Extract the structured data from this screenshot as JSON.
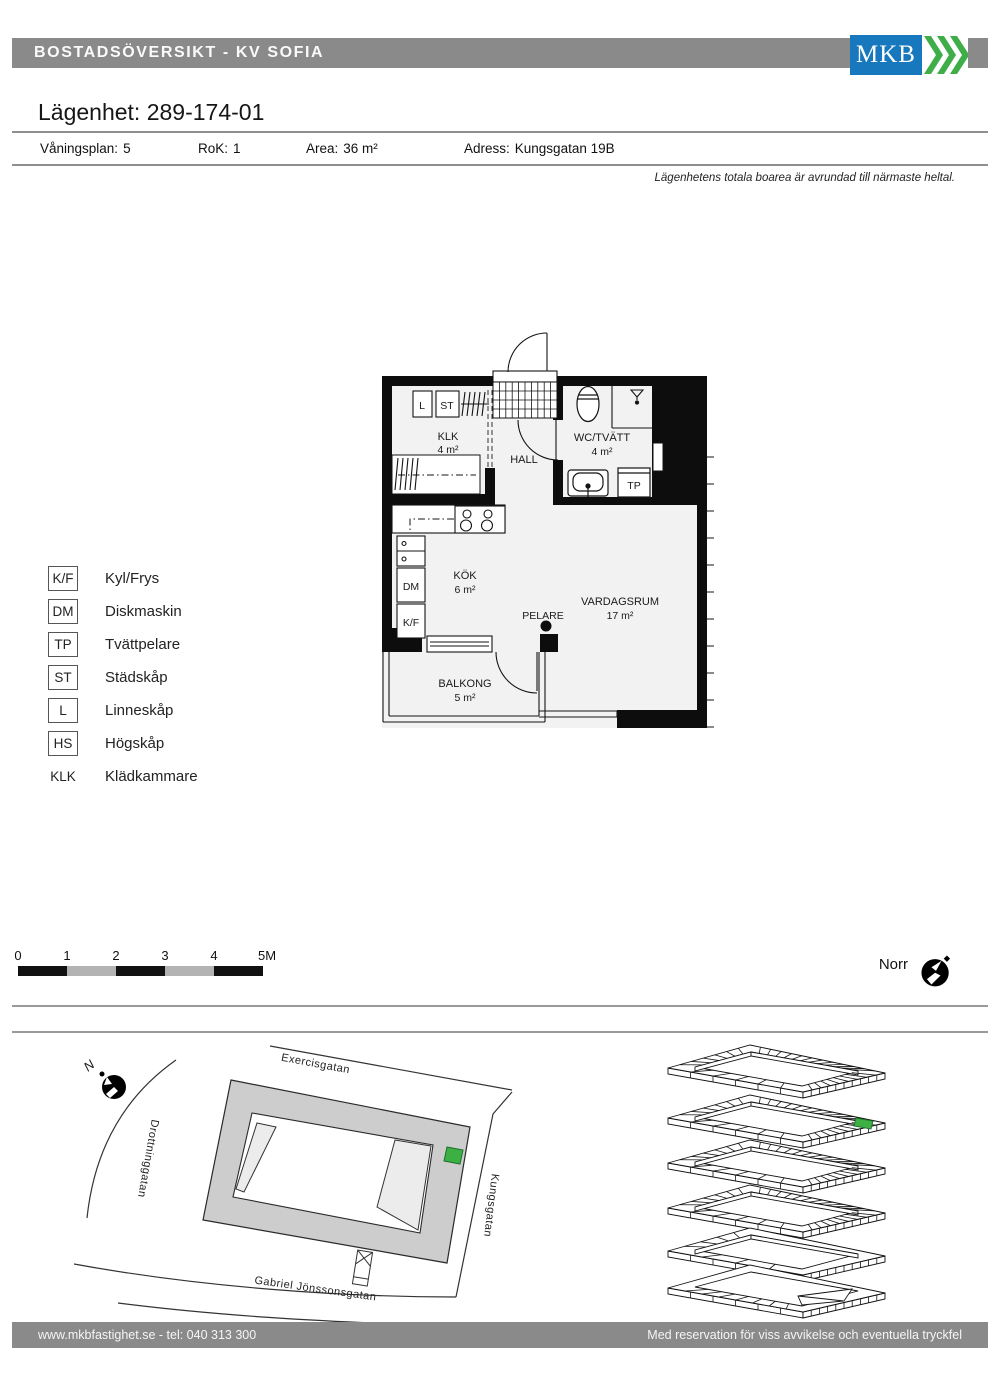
{
  "header": {
    "title": "BOSTADSÖVERSIKT - KV SOFIA",
    "logo_text": "MKB"
  },
  "apartment": {
    "title": "Lägenhet: 289-174-01",
    "info": [
      {
        "label": "Våningsplan:",
        "value": "5"
      },
      {
        "label": "RoK:",
        "value": "1"
      },
      {
        "label": "Area:",
        "value": "36 m²"
      },
      {
        "label": "Adress:",
        "value": "Kungsgatan 19B"
      }
    ],
    "note": "Lägenhetens totala boarea är avrundad till närmaste heltal."
  },
  "floorplan": {
    "rooms": [
      {
        "name": "KLK",
        "area": "4 m²"
      },
      {
        "name": "HALL",
        "area": ""
      },
      {
        "name": "WC/TVÄTT",
        "area": "4 m²"
      },
      {
        "name": "KÖK",
        "area": "6 m²"
      },
      {
        "name": "VARDAGSRUM",
        "area": "17 m²"
      },
      {
        "name": "BALKONG",
        "area": "5 m²"
      }
    ],
    "fixtures": {
      "pelare": "PELARE",
      "linneskap": "L",
      "stadskap": "ST",
      "tvattpelare": "TP",
      "diskmaskin": "DM",
      "kylfrys": "K/F"
    }
  },
  "legend": {
    "items": [
      {
        "abbr": "K/F",
        "label": "Kyl/Frys",
        "boxed": true
      },
      {
        "abbr": "DM",
        "label": "Diskmaskin",
        "boxed": true
      },
      {
        "abbr": "TP",
        "label": "Tvättpelare",
        "boxed": true
      },
      {
        "abbr": "ST",
        "label": "Städskåp",
        "boxed": true
      },
      {
        "abbr": "L",
        "label": "Linneskåp",
        "boxed": true
      },
      {
        "abbr": "HS",
        "label": "Högskåp",
        "boxed": true
      },
      {
        "abbr": "KLK",
        "label": "Klädkammare",
        "boxed": false
      }
    ]
  },
  "scalebar": {
    "labels": [
      "0",
      "1",
      "2",
      "3",
      "4",
      "5M"
    ]
  },
  "compass": {
    "north_label": "Norr",
    "site_north": "N"
  },
  "sitemap": {
    "streets": [
      "Exercisgatan",
      "Drottninggatan",
      "Kungsgatan",
      "Gabriel Jönssonsgatan"
    ]
  },
  "footer": {
    "left": "www.mkbfastighet.se - tel: 040 313 300",
    "right": "Med reservation för viss avvikelse och eventuella tryckfel"
  },
  "colors": {
    "brand_blue": "#1878BE",
    "brand_green": "#3FAE49",
    "bar_gray": "#8A8A8A",
    "plan_fill": "#F2F2F2",
    "block_gray": "#CDCDCD",
    "highlight_green": "#3CB043"
  }
}
